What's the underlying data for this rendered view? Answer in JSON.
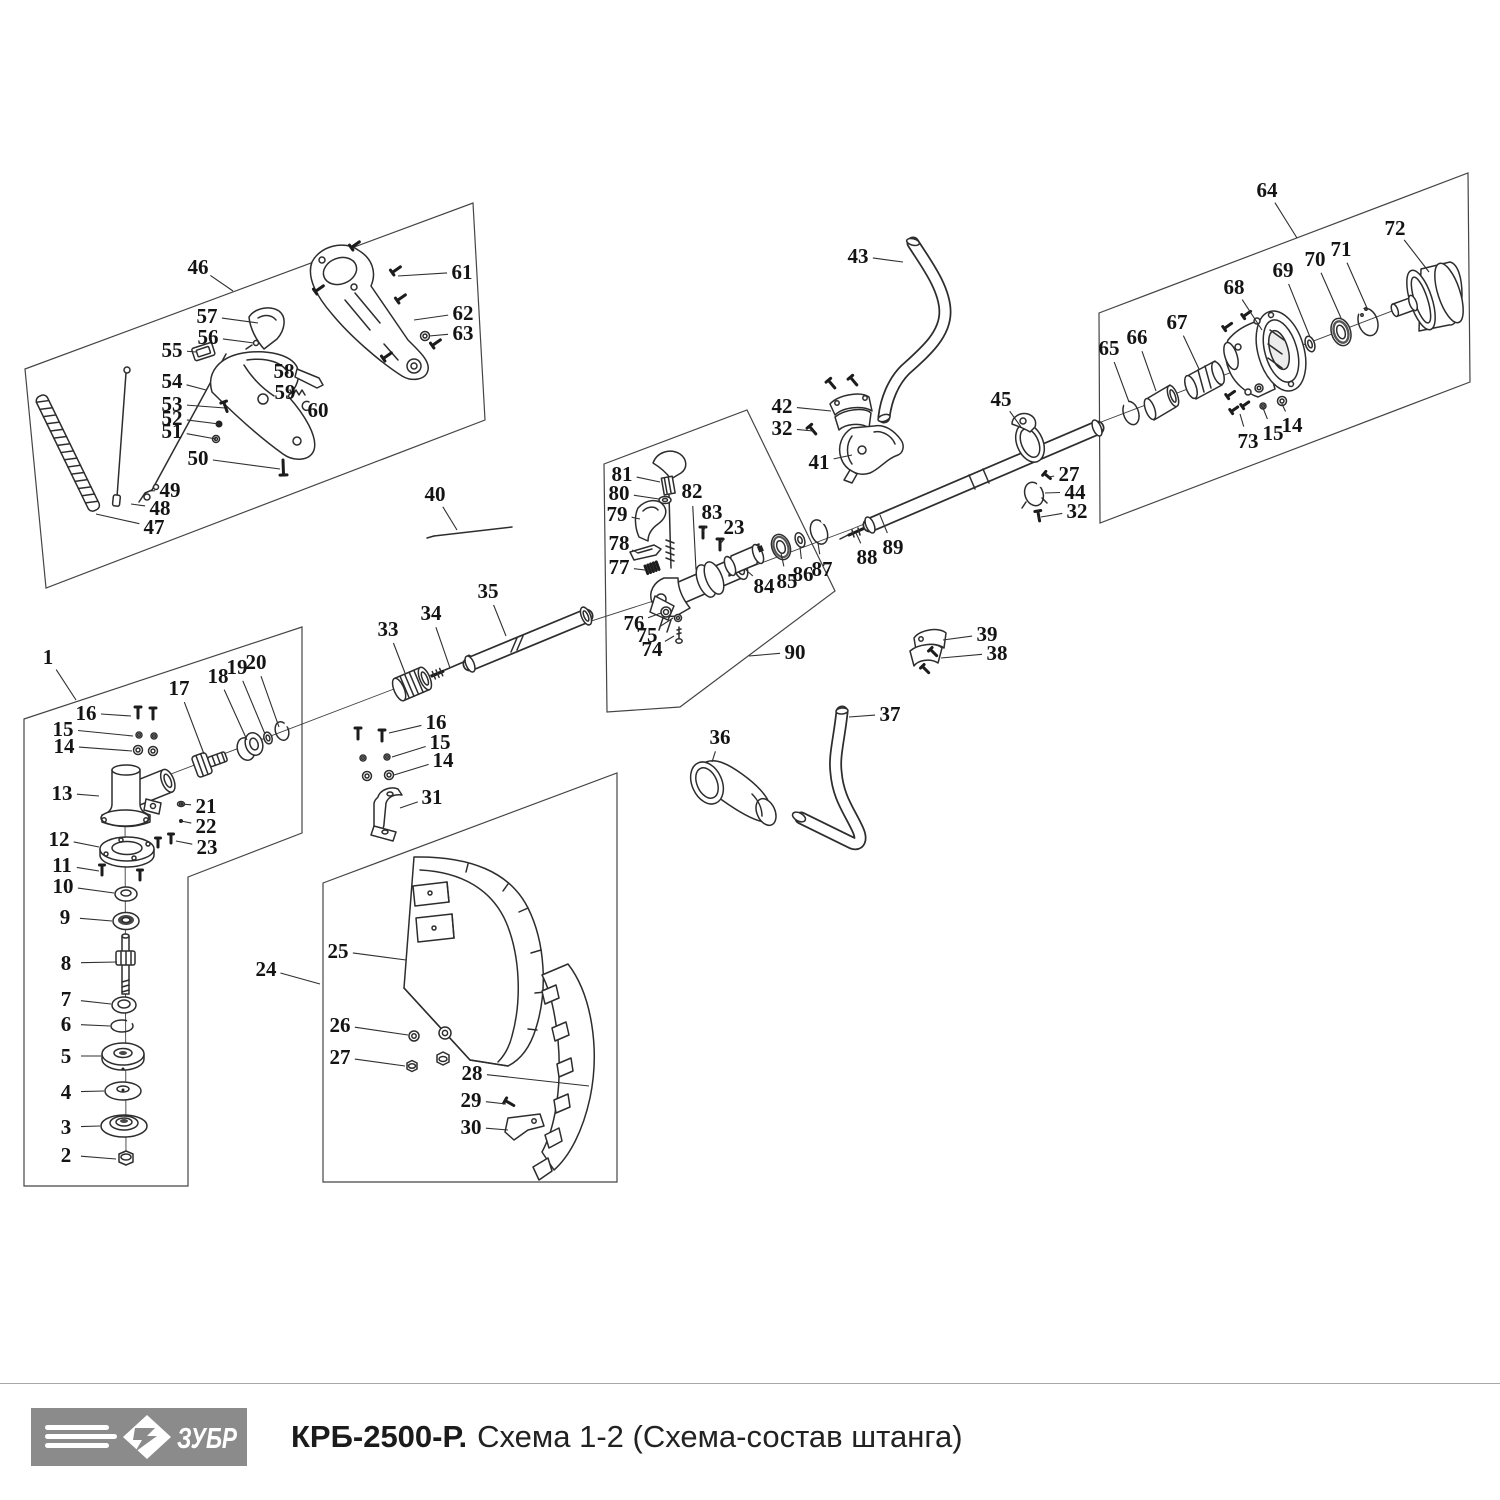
{
  "footer": {
    "brand": "ЗУБР",
    "model": "КРБ-2500-Р.",
    "scheme": "Схема 1-2 (Схема-состав штанга)",
    "logo_bg": "#8b8b8b",
    "logo_text_color": "#ffffff",
    "divider_color": "#a8a8a8"
  },
  "diagram": {
    "ink": "#2d2d2d",
    "leader_color": "#2f2f2f",
    "label_color": "#141414",
    "box_color": "#454545",
    "boxes": [
      {
        "id": "handle-assembly-46",
        "points": "25,369 473,203 485,420 46,588"
      },
      {
        "id": "gearhead-assembly-1",
        "points": "24,719 302,627 302,833 188,877 188,1186 24,1186"
      },
      {
        "id": "coupler-assembly-90",
        "points": "604,464 747,410 835,591 680,707 607,712"
      },
      {
        "id": "clutch-assembly-64",
        "points": "1099,313 1468,173 1470,382 1100,523"
      },
      {
        "id": "guard-assembly-24",
        "points": "323,883 617,773 617,1182 323,1182"
      }
    ],
    "axes": [
      {
        "x1": 150,
        "y1": 782,
        "x2": 470,
        "y2": 660
      },
      {
        "x1": 470,
        "y1": 660,
        "x2": 700,
        "y2": 586
      },
      {
        "x1": 700,
        "y1": 586,
        "x2": 852,
        "y2": 529
      },
      {
        "x1": 852,
        "y1": 529,
        "x2": 1098,
        "y2": 427
      },
      {
        "x1": 1088,
        "y1": 427,
        "x2": 1400,
        "y2": 308
      },
      {
        "x1": 125,
        "y1": 806,
        "x2": 126,
        "y2": 1158
      }
    ],
    "callouts": [
      {
        "n": "46",
        "x": 198,
        "y": 267,
        "tx": 233,
        "ty": 291
      },
      {
        "n": "61",
        "x": 462,
        "y": 272,
        "tx": 398,
        "ty": 276
      },
      {
        "n": "57",
        "x": 207,
        "y": 316,
        "tx": 258,
        "ty": 323
      },
      {
        "n": "62",
        "x": 463,
        "y": 313,
        "tx": 414,
        "ty": 320
      },
      {
        "n": "56",
        "x": 208,
        "y": 337,
        "tx": 254,
        "ty": 343
      },
      {
        "n": "63",
        "x": 463,
        "y": 333,
        "tx": 429,
        "ty": 336
      },
      {
        "n": "55",
        "x": 172,
        "y": 350,
        "tx": 196,
        "ty": 352
      },
      {
        "n": "58",
        "x": 284,
        "y": 371,
        "tx": 298,
        "ty": 374
      },
      {
        "n": "54",
        "x": 172,
        "y": 381,
        "tx": 206,
        "ty": 390
      },
      {
        "n": "59",
        "x": 285,
        "y": 392,
        "tx": 294,
        "ty": 392
      },
      {
        "n": "60",
        "x": 318,
        "y": 410,
        "tx": 306,
        "ty": 407
      },
      {
        "n": "53",
        "x": 172,
        "y": 404,
        "tx": 225,
        "ty": 408
      },
      {
        "n": "52",
        "x": 172,
        "y": 418,
        "tx": 219,
        "ty": 424
      },
      {
        "n": "51",
        "x": 172,
        "y": 431,
        "tx": 216,
        "ty": 439
      },
      {
        "n": "50",
        "x": 198,
        "y": 458,
        "tx": 280,
        "ty": 469
      },
      {
        "n": "49",
        "x": 170,
        "y": 490,
        "tx": 150,
        "ty": 491
      },
      {
        "n": "48",
        "x": 160,
        "y": 508,
        "tx": 131,
        "ty": 504
      },
      {
        "n": "47",
        "x": 154,
        "y": 527,
        "tx": 96,
        "ty": 514
      },
      {
        "n": "40",
        "x": 435,
        "y": 494,
        "tx": 457,
        "ty": 530
      },
      {
        "n": "1",
        "x": 48,
        "y": 657,
        "tx": 76,
        "ty": 700
      },
      {
        "n": "16",
        "x": 86,
        "y": 713,
        "tx": 131,
        "ty": 716
      },
      {
        "n": "15",
        "x": 63,
        "y": 729,
        "tx": 133,
        "ty": 736
      },
      {
        "n": "14",
        "x": 64,
        "y": 746,
        "tx": 132,
        "ty": 751
      },
      {
        "n": "17",
        "x": 179,
        "y": 688,
        "tx": 204,
        "ty": 754
      },
      {
        "n": "18",
        "x": 218,
        "y": 676,
        "tx": 247,
        "ty": 740
      },
      {
        "n": "19",
        "x": 237,
        "y": 667,
        "tx": 265,
        "ty": 734
      },
      {
        "n": "20",
        "x": 256,
        "y": 662,
        "tx": 279,
        "ty": 727
      },
      {
        "n": "13",
        "x": 62,
        "y": 793,
        "tx": 99,
        "ty": 796
      },
      {
        "n": "21",
        "x": 206,
        "y": 806,
        "tx": 181,
        "ty": 804
      },
      {
        "n": "22",
        "x": 206,
        "y": 826,
        "tx": 181,
        "ty": 821
      },
      {
        "n": "12",
        "x": 59,
        "y": 839,
        "tx": 99,
        "ty": 847
      },
      {
        "n": "23",
        "x": 207,
        "y": 847,
        "tx": 176,
        "ty": 841
      },
      {
        "n": "11",
        "x": 62,
        "y": 865,
        "tx": 99,
        "ty": 871
      },
      {
        "n": "10",
        "x": 63,
        "y": 886,
        "tx": 114,
        "ty": 893
      },
      {
        "n": "9",
        "x": 65,
        "y": 917,
        "tx": 112,
        "ty": 921
      },
      {
        "n": "8",
        "x": 66,
        "y": 963,
        "tx": 117,
        "ty": 962
      },
      {
        "n": "7",
        "x": 66,
        "y": 999,
        "tx": 111,
        "ty": 1004
      },
      {
        "n": "6",
        "x": 66,
        "y": 1024,
        "tx": 110,
        "ty": 1026
      },
      {
        "n": "5",
        "x": 66,
        "y": 1056,
        "tx": 101,
        "ty": 1056
      },
      {
        "n": "4",
        "x": 66,
        "y": 1092,
        "tx": 104,
        "ty": 1091
      },
      {
        "n": "3",
        "x": 66,
        "y": 1127,
        "tx": 100,
        "ty": 1126
      },
      {
        "n": "2",
        "x": 66,
        "y": 1155,
        "tx": 116,
        "ty": 1159
      },
      {
        "n": "33",
        "x": 388,
        "y": 629,
        "tx": 405,
        "ty": 673
      },
      {
        "n": "34",
        "x": 431,
        "y": 613,
        "tx": 450,
        "ty": 668
      },
      {
        "n": "35",
        "x": 488,
        "y": 591,
        "tx": 506,
        "ty": 636
      },
      {
        "n": "16",
        "x": 436,
        "y": 722,
        "tx": 389,
        "ty": 733
      },
      {
        "n": "15",
        "x": 440,
        "y": 742,
        "tx": 392,
        "ty": 757
      },
      {
        "n": "14",
        "x": 443,
        "y": 760,
        "tx": 394,
        "ty": 775
      },
      {
        "n": "31",
        "x": 432,
        "y": 797,
        "tx": 400,
        "ty": 808
      },
      {
        "n": "24",
        "x": 266,
        "y": 969,
        "tx": 320,
        "ty": 984
      },
      {
        "n": "25",
        "x": 338,
        "y": 951,
        "tx": 406,
        "ty": 960
      },
      {
        "n": "26",
        "x": 340,
        "y": 1025,
        "tx": 408,
        "ty": 1035
      },
      {
        "n": "27",
        "x": 340,
        "y": 1057,
        "tx": 405,
        "ty": 1066
      },
      {
        "n": "28",
        "x": 472,
        "y": 1073,
        "tx": 589,
        "ty": 1086
      },
      {
        "n": "29",
        "x": 471,
        "y": 1100,
        "tx": 506,
        "ty": 1104
      },
      {
        "n": "30",
        "x": 471,
        "y": 1127,
        "tx": 508,
        "ty": 1130
      },
      {
        "n": "81",
        "x": 622,
        "y": 474,
        "tx": 660,
        "ty": 482
      },
      {
        "n": "80",
        "x": 619,
        "y": 493,
        "tx": 659,
        "ty": 499
      },
      {
        "n": "82",
        "x": 692,
        "y": 491,
        "tx": 696,
        "ty": 570
      },
      {
        "n": "79",
        "x": 617,
        "y": 514,
        "tx": 640,
        "ty": 519
      },
      {
        "n": "83",
        "x": 712,
        "y": 512,
        "tx": 703,
        "ty": 532
      },
      {
        "n": "23",
        "x": 734,
        "y": 527,
        "tx": 721,
        "ty": 543
      },
      {
        "n": "78",
        "x": 619,
        "y": 543,
        "tx": 638,
        "ty": 553
      },
      {
        "n": "77",
        "x": 619,
        "y": 567,
        "tx": 645,
        "ty": 570
      },
      {
        "n": "76",
        "x": 634,
        "y": 623,
        "tx": 661,
        "ty": 613
      },
      {
        "n": "75",
        "x": 647,
        "y": 635,
        "tx": 673,
        "ty": 618
      },
      {
        "n": "74",
        "x": 652,
        "y": 649,
        "tx": 674,
        "ty": 636
      },
      {
        "n": "84",
        "x": 764,
        "y": 586,
        "tx": 745,
        "ty": 569
      },
      {
        "n": "85",
        "x": 787,
        "y": 581,
        "tx": 781,
        "ty": 553
      },
      {
        "n": "86",
        "x": 803,
        "y": 574,
        "tx": 800,
        "ty": 547
      },
      {
        "n": "87",
        "x": 822,
        "y": 569,
        "tx": 818,
        "ty": 543
      },
      {
        "n": "90",
        "x": 795,
        "y": 652,
        "tx": 749,
        "ty": 656
      },
      {
        "n": "43",
        "x": 858,
        "y": 256,
        "tx": 903,
        "ty": 262
      },
      {
        "n": "42",
        "x": 782,
        "y": 406,
        "tx": 831,
        "ty": 411
      },
      {
        "n": "32",
        "x": 782,
        "y": 428,
        "tx": 813,
        "ty": 431
      },
      {
        "n": "41",
        "x": 819,
        "y": 462,
        "tx": 852,
        "ty": 455
      },
      {
        "n": "45",
        "x": 1001,
        "y": 399,
        "tx": 1021,
        "ty": 427
      },
      {
        "n": "27",
        "x": 1069,
        "y": 474,
        "tx": 1048,
        "ty": 477
      },
      {
        "n": "44",
        "x": 1075,
        "y": 492,
        "tx": 1045,
        "ty": 493
      },
      {
        "n": "32",
        "x": 1077,
        "y": 511,
        "tx": 1041,
        "ty": 517
      },
      {
        "n": "88",
        "x": 867,
        "y": 557,
        "tx": 856,
        "ty": 533
      },
      {
        "n": "89",
        "x": 893,
        "y": 547,
        "tx": 880,
        "ty": 515
      },
      {
        "n": "39",
        "x": 987,
        "y": 634,
        "tx": 943,
        "ty": 640
      },
      {
        "n": "38",
        "x": 997,
        "y": 653,
        "tx": 941,
        "ty": 658
      },
      {
        "n": "37",
        "x": 890,
        "y": 714,
        "tx": 849,
        "ty": 717
      },
      {
        "n": "36",
        "x": 720,
        "y": 737,
        "tx": 712,
        "ty": 762
      },
      {
        "n": "64",
        "x": 1267,
        "y": 190,
        "tx": 1297,
        "ty": 238
      },
      {
        "n": "72",
        "x": 1395,
        "y": 228,
        "tx": 1429,
        "ty": 272
      },
      {
        "n": "71",
        "x": 1341,
        "y": 249,
        "tx": 1367,
        "ty": 308
      },
      {
        "n": "70",
        "x": 1315,
        "y": 259,
        "tx": 1341,
        "ty": 318
      },
      {
        "n": "69",
        "x": 1283,
        "y": 270,
        "tx": 1310,
        "ty": 337
      },
      {
        "n": "68",
        "x": 1234,
        "y": 287,
        "tx": 1262,
        "ty": 330
      },
      {
        "n": "67",
        "x": 1177,
        "y": 322,
        "tx": 1199,
        "ty": 369
      },
      {
        "n": "66",
        "x": 1137,
        "y": 337,
        "tx": 1156,
        "ty": 391
      },
      {
        "n": "65",
        "x": 1109,
        "y": 348,
        "tx": 1129,
        "ty": 402
      },
      {
        "n": "73",
        "x": 1248,
        "y": 441,
        "tx": 1240,
        "ty": 414
      },
      {
        "n": "15",
        "x": 1273,
        "y": 433,
        "tx": 1263,
        "ty": 408
      },
      {
        "n": "14",
        "x": 1292,
        "y": 425,
        "tx": 1282,
        "ty": 404
      }
    ]
  }
}
